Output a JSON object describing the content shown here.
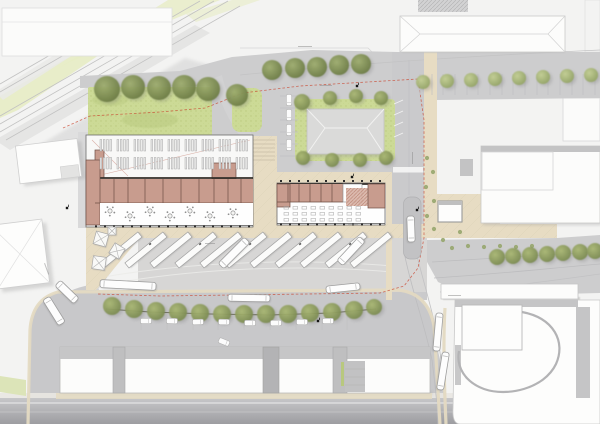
{
  "meta": {
    "title": "Bus station site plan — architectural masterplan drawing",
    "canvas_w": 600,
    "canvas_h": 424
  },
  "palette": {
    "background": "#f3f3f2",
    "road": "#cdcdce",
    "road_dark": "#a2a2a6",
    "apron": "#d7d6d5",
    "precinct": "#c8c8ca",
    "plaza": "#e7dcc3",
    "curb": "#e4dac2",
    "lawn": "#ccda96",
    "lawn_dark": "#b6c77d",
    "tree_dark": "#6c7c48",
    "tree_light": "#94a468",
    "building_white": "#fcfcfb",
    "roof_gray": "#dadad9",
    "roof_band": "#c3c3c4",
    "room_fill": "#c89c8e",
    "room_wall": "#6e4f44",
    "wall_dark": "#332e29",
    "rail": "#c2c2c2",
    "boundary_red": "#c9442e",
    "shadow": "#a7a7a7"
  },
  "scene": {
    "trees": {
      "lawn_large": [
        [
          107,
          89,
          13
        ],
        [
          133,
          87,
          12
        ],
        [
          159,
          88,
          12
        ],
        [
          184,
          87,
          12
        ],
        [
          208,
          89,
          12
        ],
        [
          237,
          95,
          11
        ]
      ],
      "road_main": [
        [
          272,
          70,
          10
        ],
        [
          295,
          68,
          10
        ],
        [
          317,
          67,
          10
        ],
        [
          339,
          65,
          10
        ],
        [
          361,
          64,
          10
        ]
      ],
      "road_small": [
        [
          423,
          82,
          7
        ],
        [
          447,
          81,
          7
        ],
        [
          471,
          80,
          7
        ],
        [
          495,
          79,
          7
        ],
        [
          519,
          78,
          7
        ],
        [
          543,
          77,
          7
        ],
        [
          567,
          76,
          7
        ],
        [
          591,
          75,
          7
        ]
      ],
      "center_ring": [
        [
          302,
          102,
          8
        ],
        [
          330,
          98,
          7
        ],
        [
          356,
          96,
          7
        ],
        [
          381,
          98,
          7
        ],
        [
          303,
          158,
          7
        ],
        [
          332,
          160,
          7
        ],
        [
          360,
          160,
          7
        ],
        [
          386,
          158,
          7
        ]
      ],
      "hedge_row": [
        [
          112,
          306,
          9
        ],
        [
          134,
          309,
          9
        ],
        [
          156,
          311,
          9
        ],
        [
          178,
          312,
          9
        ],
        [
          200,
          313,
          9
        ],
        [
          222,
          314,
          9
        ],
        [
          244,
          314,
          9
        ],
        [
          266,
          314,
          9
        ],
        [
          288,
          314,
          9
        ],
        [
          310,
          313,
          9
        ],
        [
          332,
          312,
          9
        ],
        [
          354,
          310,
          9
        ],
        [
          374,
          307,
          8
        ]
      ],
      "east_road": [
        [
          497,
          257,
          8
        ],
        [
          513,
          256,
          8
        ],
        [
          530,
          255,
          8
        ],
        [
          547,
          254,
          8
        ],
        [
          563,
          253,
          8
        ],
        [
          580,
          252,
          8
        ],
        [
          595,
          251,
          8
        ]
      ],
      "dots": [
        [
          427,
          158
        ],
        [
          433,
          172
        ],
        [
          426,
          187
        ],
        [
          434,
          201
        ],
        [
          427,
          216
        ],
        [
          434,
          229
        ],
        [
          443,
          240
        ],
        [
          452,
          248
        ],
        [
          468,
          246
        ],
        [
          484,
          247
        ],
        [
          500,
          246
        ],
        [
          516,
          247
        ],
        [
          532,
          246
        ],
        [
          460,
          232
        ]
      ]
    },
    "platforms": {
      "count": 11,
      "start_x": 104,
      "spacing": 25,
      "base_y": 268,
      "length": 49,
      "width": 6.5,
      "angle": -39.2
    },
    "buses": [
      {
        "x": 128,
        "y": 285,
        "l": 56,
        "w": 8,
        "a": 3
      },
      {
        "x": 234,
        "y": 253,
        "l": 37,
        "w": 8,
        "a": -45
      },
      {
        "x": 351,
        "y": 251,
        "l": 33,
        "w": 8,
        "a": -47
      },
      {
        "x": 249,
        "y": 298,
        "l": 42,
        "w": 7,
        "a": 1
      },
      {
        "x": 343,
        "y": 288,
        "l": 34,
        "w": 7,
        "a": -6
      },
      {
        "x": 54,
        "y": 311,
        "l": 30,
        "w": 8,
        "a": 58
      },
      {
        "x": 67,
        "y": 292,
        "l": 26,
        "w": 8,
        "a": 44
      },
      {
        "x": 411,
        "y": 229,
        "l": 26,
        "w": 7.5,
        "a": 88
      },
      {
        "x": 438,
        "y": 332,
        "l": 38,
        "w": 7,
        "a": 95
      },
      {
        "x": 443,
        "y": 371,
        "l": 38,
        "w": 7,
        "a": 99
      }
    ],
    "cars": [
      [
        146,
        321,
        0
      ],
      [
        172,
        321,
        2
      ],
      [
        198,
        322,
        -2
      ],
      [
        224,
        322,
        1
      ],
      [
        250,
        323,
        0
      ],
      [
        276,
        323,
        -1
      ],
      [
        302,
        322,
        1
      ],
      [
        328,
        321,
        0
      ],
      [
        224,
        342,
        22
      ],
      [
        289,
        100,
        90
      ],
      [
        289,
        115,
        90
      ],
      [
        289,
        130,
        90
      ],
      [
        289,
        145,
        90
      ]
    ],
    "parasols": [
      [
        101,
        239,
        15,
        13
      ],
      [
        117,
        251,
        32,
        12
      ],
      [
        99,
        263,
        8,
        13
      ],
      [
        112,
        231,
        0,
        8
      ]
    ],
    "tables": [
      [
        110,
        211
      ],
      [
        130,
        216
      ],
      [
        150,
        211
      ],
      [
        170,
        216
      ],
      [
        190,
        211
      ],
      [
        210,
        216
      ],
      [
        233,
        213
      ]
    ],
    "furn_grid": {
      "x0": 284,
      "step": 9,
      "count": 9,
      "rows": [
        206.5,
        212.5,
        218.5
      ],
      "w": 4.6,
      "h": 2.6
    },
    "columns": [
      {
        "y": 226.5,
        "x0": 96,
        "x1": 250,
        "s": 9
      },
      {
        "y": 224.5,
        "x0": 281,
        "x1": 383,
        "s": 9
      },
      {
        "y": 181,
        "x0": 281,
        "x1": 383,
        "s": 9
      }
    ],
    "skylights": {
      "rows": [
        139.5,
        157.5
      ],
      "x0": 100,
      "count": 9,
      "step": 17,
      "bars": 4,
      "bw": 1.7,
      "bh": 11.5,
      "gap": 3.3
    },
    "stall_lines": [
      [
        141,
        314,
        141,
        330
      ],
      [
        167,
        314,
        167,
        330
      ],
      [
        193,
        314,
        193,
        330
      ],
      [
        218,
        314,
        218,
        330
      ],
      [
        244,
        314,
        244,
        330
      ],
      [
        270,
        314,
        270,
        330
      ],
      [
        296,
        314,
        296,
        330
      ],
      [
        322,
        314,
        322,
        330
      ],
      [
        347,
        314,
        347,
        330
      ],
      [
        420,
        74,
        420,
        95
      ],
      [
        432,
        74,
        432,
        95
      ],
      [
        443,
        74,
        443,
        95
      ],
      [
        455,
        74,
        455,
        95
      ],
      [
        467,
        74,
        467,
        95
      ],
      [
        478,
        74,
        478,
        95
      ],
      [
        490,
        74,
        490,
        95
      ],
      [
        502,
        74,
        502,
        95
      ],
      [
        513,
        74,
        513,
        95
      ],
      [
        525,
        74,
        525,
        95
      ],
      [
        537,
        74,
        537,
        95
      ],
      [
        548,
        74,
        548,
        95
      ],
      [
        560,
        74,
        560,
        95
      ],
      [
        572,
        74,
        572,
        95
      ],
      [
        583,
        74,
        583,
        95
      ],
      [
        595,
        74,
        595,
        95
      ],
      [
        280,
        96,
        298,
        96
      ],
      [
        280,
        108,
        298,
        108
      ],
      [
        280,
        120,
        298,
        120
      ],
      [
        280,
        132,
        298,
        132
      ],
      [
        280,
        144,
        298,
        144
      ],
      [
        280,
        156,
        298,
        156
      ]
    ],
    "white_stalls": [
      [
        394,
        104,
        403,
        100
      ],
      [
        394,
        115,
        403,
        111
      ],
      [
        394,
        126,
        403,
        122
      ],
      [
        394,
        137,
        403,
        133
      ]
    ],
    "black_symbols": [
      [
        67,
        208
      ],
      [
        352,
        177
      ],
      [
        318,
        321
      ],
      [
        417,
        210
      ],
      [
        357,
        86
      ]
    ],
    "label_dashes": [
      [
        298,
        46,
        14,
        0
      ],
      [
        320,
        85,
        12,
        0
      ],
      [
        448,
        295,
        13,
        0
      ],
      [
        413,
        152,
        12,
        90
      ],
      [
        45,
        263,
        12,
        70
      ],
      [
        348,
        224,
        10,
        0
      ],
      [
        205,
        243,
        10,
        0
      ]
    ]
  }
}
